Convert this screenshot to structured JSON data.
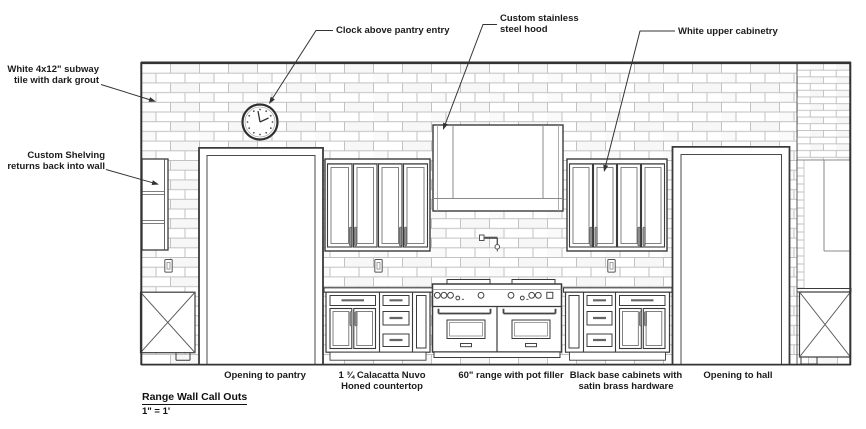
{
  "drawing": {
    "title": "Range Wall Call Outs",
    "scale_note": "1\" = 1'",
    "callouts": {
      "subway_tile": "White 4x12\" subway\ntile with dark grout",
      "shelving": "Custom Shelving\nreturns back into wall",
      "clock": "Clock above pantry entry",
      "hood": "Custom stainless\nsteel hood",
      "upper_cabinets": "White upper cabinetry"
    },
    "labels": {
      "pantry_opening": "Opening to pantry",
      "countertop": "1 ¾ Calacatta Nuvo\nHoned countertop",
      "range": "60\" range with pot filler",
      "base_cabinets": "Black base cabinets with\nsatin brass hardware",
      "hall_opening": "Opening to hall"
    },
    "colors": {
      "ink": "#3b3b3b",
      "grout": "#c2c2c2",
      "paper": "#ffffff"
    }
  }
}
